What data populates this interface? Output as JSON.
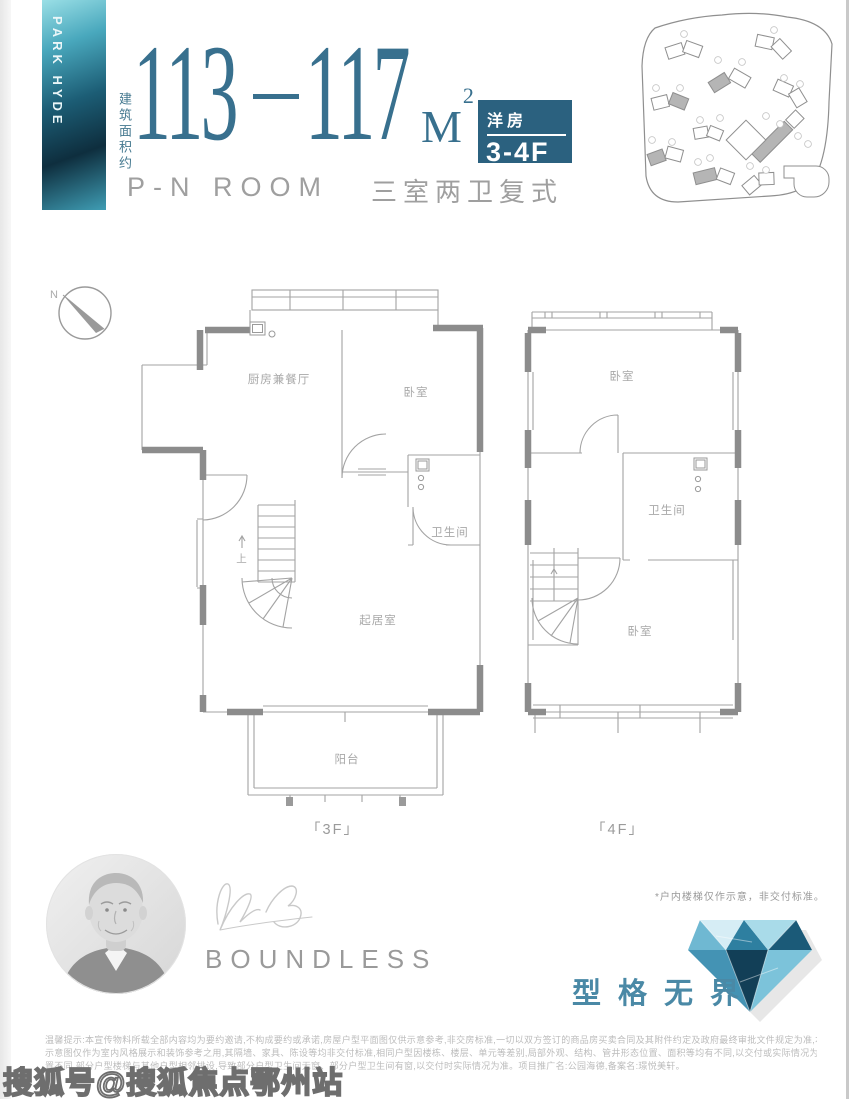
{
  "header": {
    "brand_vertical": "PARK HYDE",
    "area_label": "建筑面积约",
    "area_from": "113",
    "area_to": "117",
    "area_unit": "M",
    "area_sup": "2",
    "badge_type": "洋房",
    "badge_floors": "3-4F",
    "subtitle_en": "P-N ROOM",
    "subtitle_cn": "三室两卫复式"
  },
  "compass": {
    "north": "N"
  },
  "plans": {
    "left": {
      "floor_label": "「3F」",
      "kitchen_dining": "厨房兼餐厅",
      "bedroom": "卧室",
      "bathroom": "卫生间",
      "living": "起居室",
      "balcony": "阳台",
      "stair_up": "上"
    },
    "right": {
      "floor_label": "「4F」",
      "bedroom_top": "卧室",
      "bathroom": "卫生间",
      "bedroom_bottom": "卧室"
    }
  },
  "footer": {
    "brand_word": "BOUNDLESS",
    "stair_note": "*户内楼梯仅作示意，非交付标准。",
    "slogan": "型格无界",
    "disclaimer": [
      "温馨提示:本宣传物料所载全部内容均为要约邀请,不构成要约或承诺,房屋户型平面图仅供示意参考,非交房标准,一切以双方签订的商品房买卖合同及其附件约定及政府最终审批文件规定为准,本宣传物料的户型",
      "示意图仅作为室内风格展示和装饰参考之用,其隔墙、家具、陈设等均非交付标准,相同户型因楼栋、楼层、单元等差别,局部外观、结构、管井形态位置、面积等均有不同,以交付或实际情况为准,相同户型图所在楼栋位",
      "置不同,部分户型楼梯与其他户型相邻排设,导致部分户型卫生间无窗、部分户型卫生间有窗,以交付时实际情况为准。项目推广名:公园海德,备案名:璟悦美轩。"
    ],
    "watermark": "搜狐号@搜狐焦点鄂州站"
  },
  "colors": {
    "accent_blue": "#38708e",
    "badge_blue": "#2b617f",
    "slogan_teal": "#4a89a6",
    "wall_gray": "#8c8c8c",
    "text_gray": "#9c9c9c"
  }
}
